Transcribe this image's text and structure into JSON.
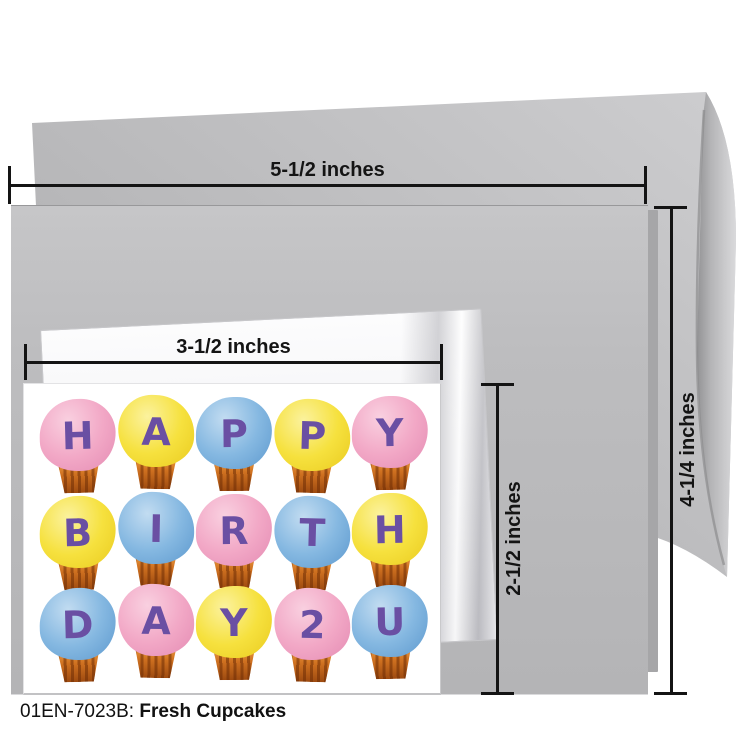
{
  "caption": {
    "code": "01EN-7023B:",
    "title": "Fresh Cupcakes"
  },
  "measurements": {
    "large_card_width": "5-1/2 inches",
    "large_card_height": "4-1/4 inches",
    "small_card_width": "3-1/2 inches",
    "small_card_height": "2-1/2 inches",
    "line_color": "#141414"
  },
  "card_art": {
    "message": "HAPPY BIRTH DAY 2 U",
    "rows": [
      {
        "letters": [
          "H",
          "A",
          "P",
          "P",
          "Y"
        ],
        "colors": [
          "pink",
          "yellow",
          "blue",
          "yellow",
          "pink"
        ]
      },
      {
        "letters": [
          "B",
          "I",
          "R",
          "T",
          "H"
        ],
        "colors": [
          "yellow",
          "blue",
          "pink",
          "blue",
          "yellow"
        ]
      },
      {
        "letters": [
          "D",
          "A",
          "Y",
          "2",
          "U"
        ],
        "colors": [
          "blue",
          "pink",
          "yellow",
          "pink",
          "blue"
        ]
      }
    ],
    "palette": {
      "pink": {
        "base": "#f2a8c6",
        "light": "#f9d0e0",
        "edge": "#e791b7"
      },
      "yellow": {
        "base": "#f6e13e",
        "light": "#fbf29e",
        "edge": "#eccf25"
      },
      "blue": {
        "base": "#85b8e1",
        "light": "#c2dcf1",
        "edge": "#659fd2"
      },
      "wrapper": {
        "light": "#efa348",
        "mid": "#cf7120",
        "dark": "#9d4a10"
      },
      "letter_purple": "#6a4fa3"
    },
    "envelope_color": "#b9b9bb",
    "large_card_color": "#bdbdbf",
    "small_card_color": "#ffffff"
  }
}
